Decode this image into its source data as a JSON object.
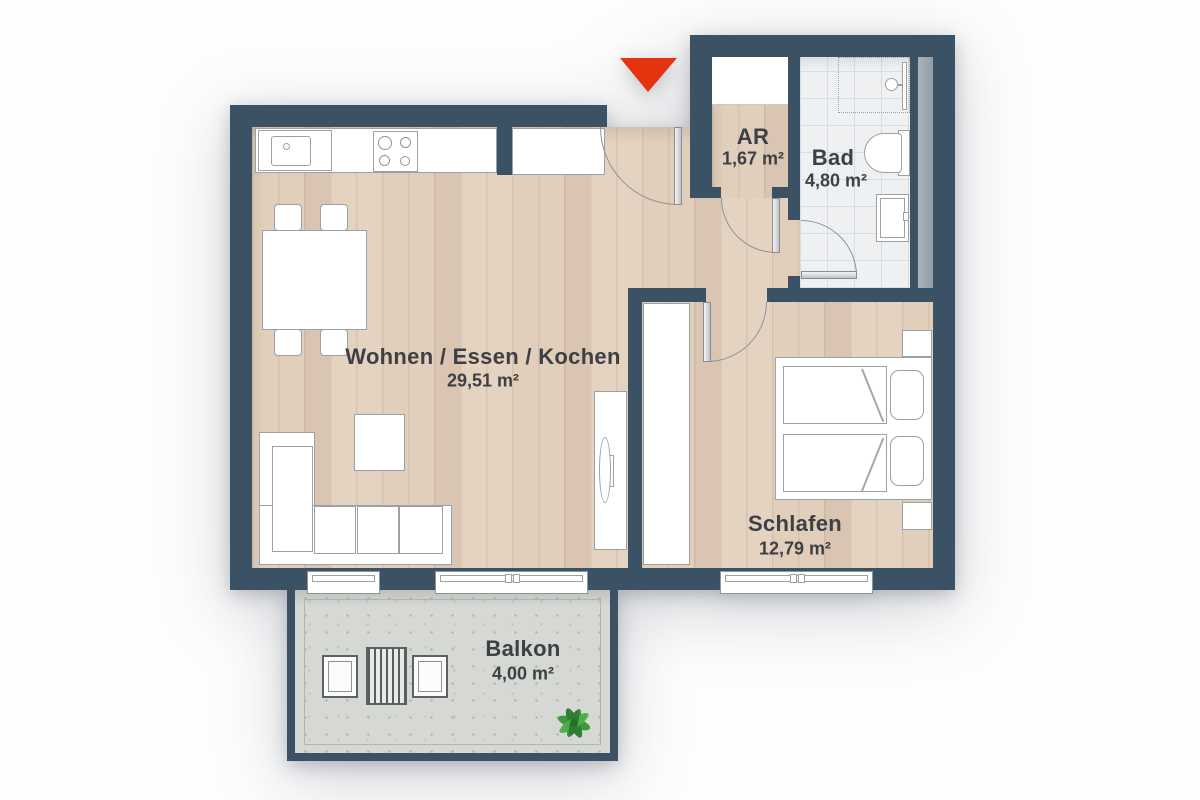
{
  "title": "Apartment floor plan",
  "entrance": {
    "icon": "entrance-arrow-down-icon",
    "color": "#e5330f"
  },
  "rooms": [
    {
      "id": "wohnen",
      "name": "Wohnen / Essen / Kochen",
      "area": "29,51 m²"
    },
    {
      "id": "schlafen",
      "name": "Schlafen",
      "area": "12,79 m²"
    },
    {
      "id": "ar",
      "name": "AR",
      "area": "1,67 m²"
    },
    {
      "id": "bad",
      "name": "Bad",
      "area": "4,80 m²"
    },
    {
      "id": "balkon",
      "name": "Balkon",
      "area": "4,00 m²"
    }
  ],
  "fixtures": [
    "kitchen-sink",
    "stove",
    "tall-cabinet",
    "dining-table",
    "chairs",
    "corner-sofa",
    "coffee-table",
    "tv-board",
    "tv",
    "double-bed",
    "pillows",
    "nightstands",
    "wardrobe",
    "shower",
    "toilet",
    "washbasin",
    "balcony-table",
    "balcony-chairs",
    "plant",
    "windows",
    "door-swings"
  ],
  "colors": {
    "wall": "#3b5164",
    "wood_floor": "#dccab7",
    "tile_floor": "#eef0f2",
    "concrete_floor": "#d6d8d4",
    "furniture": "#ffffff",
    "outline": "#9aa1a7",
    "arrow": "#e5330f",
    "shaft": "#9ba4ab",
    "plant": "#3f9b3a"
  }
}
